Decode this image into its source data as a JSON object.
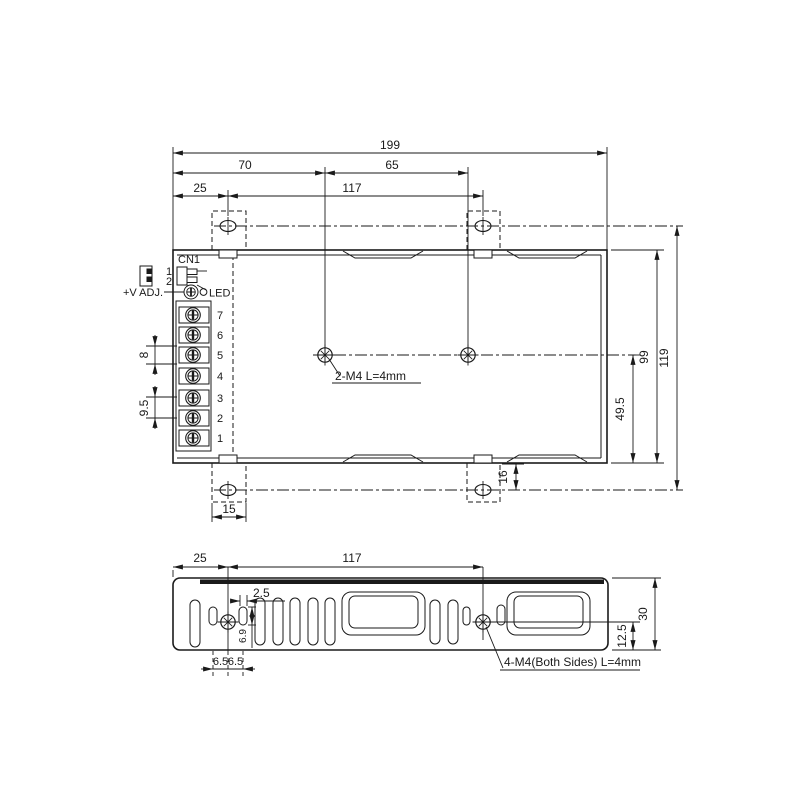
{
  "drawing": {
    "top_view": {
      "dim_total_width": "199",
      "dim_chassis_hole_offset_x": "70",
      "dim_chassis_hole_spacing": "65",
      "dim_bracket_hole_offset_x": "25",
      "dim_bracket_hole_spacing": "117",
      "dim_total_height": "119",
      "dim_case_height": "99",
      "dim_chassis_hole_offset_y": "49.5",
      "dim_bracket_hole_offset_y": "16",
      "dim_bracket_width": "15",
      "dim_terminal_pitch_a": "8",
      "dim_terminal_pitch_b": "9.5",
      "note_chassis_holes": "2-M4 L=4mm",
      "label_cn1": "CN1",
      "label_vadj": "+V ADJ.",
      "label_led": "LED",
      "label_pin1": "1",
      "label_pin2": "2",
      "terminals": [
        "7",
        "6",
        "5",
        "4",
        "3",
        "2",
        "1"
      ]
    },
    "side_view": {
      "dim_hole_offset_x": "25",
      "dim_hole_spacing": "117",
      "dim_slot_width": "2.5",
      "dim_slot_height": "6.9",
      "dim_slot_spacing_a": "6.5",
      "dim_slot_spacing_b": "6.5",
      "dim_height": "30",
      "dim_hole_offset_y": "12.5",
      "note_side_holes": "4-M4(Both Sides) L=4mm"
    }
  }
}
